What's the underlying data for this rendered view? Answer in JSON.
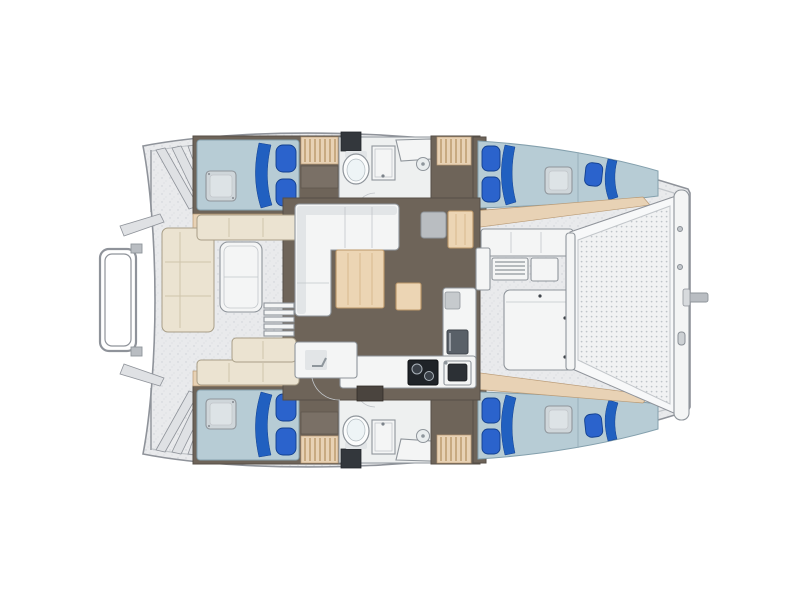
{
  "diagram": {
    "type": "floor-plan",
    "subject": "catamaran-yacht-deck-and-interior-layout",
    "orientation": {
      "bow": "right",
      "stern": "left",
      "top_side": "port-hull",
      "bottom_side": "starboard-hull"
    },
    "regions": {
      "stern": [
        "transom-steps",
        "swim-platform",
        "dinghy-davit-frame"
      ],
      "aft_cockpit": [
        "l-seat",
        "bench-seats",
        "cockpit-table",
        "entry-steps"
      ],
      "saloon": [
        "l-shaped-sofa",
        "dining-table",
        "nav-seat",
        "nav-table",
        "chart-desk",
        "island-cabinet",
        "companionway-step"
      ],
      "galley": [
        "counter",
        "two-burner-stove",
        "sink",
        "fridge",
        "appliance"
      ],
      "port_hull": [
        "aft-double-berth",
        "deck-hatch",
        "wardrobe",
        "head-compartment",
        "toilet",
        "shower",
        "vanity-counter",
        "drain",
        "companionway-stairs",
        "forward-double-berth",
        "forepeak-berth"
      ],
      "starboard_hull": [
        "mirror-duplicate-of-port-hull"
      ],
      "bow": [
        "forward-cockpit-benches",
        "vent-grille",
        "deck-locker",
        "trampoline-net",
        "forward-crossbeam",
        "bowsprit"
      ]
    },
    "berth_count": 4,
    "head_count": 2
  },
  "colors": {
    "hull_outline": "#8f939a",
    "deck_base": "#e9eaec",
    "speckle": "#cdd1d6",
    "speckle2": "#d9dcdf",
    "deck_inner_line": "#c2c6ca",
    "interior_floor": "#6e6459",
    "interior_floor_edge": "#554e46",
    "bath_floor": "#eef0f0",
    "bed": "#b7ccd5",
    "bed_edge": "#84a0ad",
    "blanket": "#2160c0",
    "pillow": "#2b63cc",
    "pillow_edge": "#123f8e",
    "hatch": "#cfd6da",
    "hatch_inner": "#dde3e6",
    "wood": "#ecd5b4",
    "wood_edge": "#bb9668",
    "wood_grain": "#d9b98e",
    "wood_shelf": "#e8d2b5",
    "shelf_edge": "#b99a75",
    "shelf_rib": "#b3905f",
    "cream": "#ebe3d1",
    "cream_edge": "#a89e87",
    "cream_seam": "#cfc5ac",
    "white_furn": "#f4f5f5",
    "furn_inner": "#e2e5e7",
    "furn_edge": "#8f959b",
    "gray_seat": "#b9bdc1",
    "stove": "#1f2328",
    "dark_box": "#33373c",
    "step_dark": "#4a443e",
    "mesh_base": "#f1f2f3",
    "mesh_dot": "#bfc4c9",
    "metal": "#b9bdc2",
    "transom_step": "#dfe1e4"
  }
}
